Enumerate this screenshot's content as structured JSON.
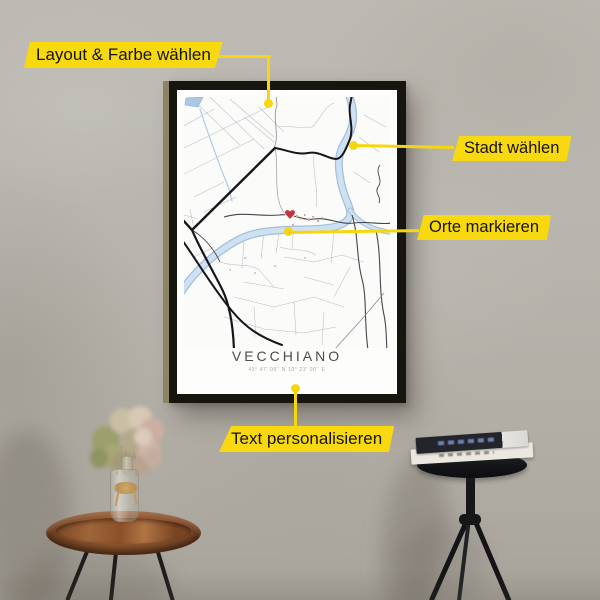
{
  "callouts": {
    "layout": {
      "label": "Layout & Farbe wählen"
    },
    "city": {
      "label": "Stadt wählen"
    },
    "places": {
      "label": "Orte markieren"
    },
    "text": {
      "label": "Text personalisieren"
    }
  },
  "poster": {
    "title": "VECCHIANO",
    "coordinates": "43° 47' 00'' N  10° 23' 00'' E"
  },
  "colors": {
    "callout_yellow": "#f8d90f",
    "callout_text": "#16130c",
    "heart_red": "#c4323c",
    "river_blue": "#b9d2ea",
    "frame_black": "#17150f",
    "wall_gray": "#b6b2ab"
  }
}
